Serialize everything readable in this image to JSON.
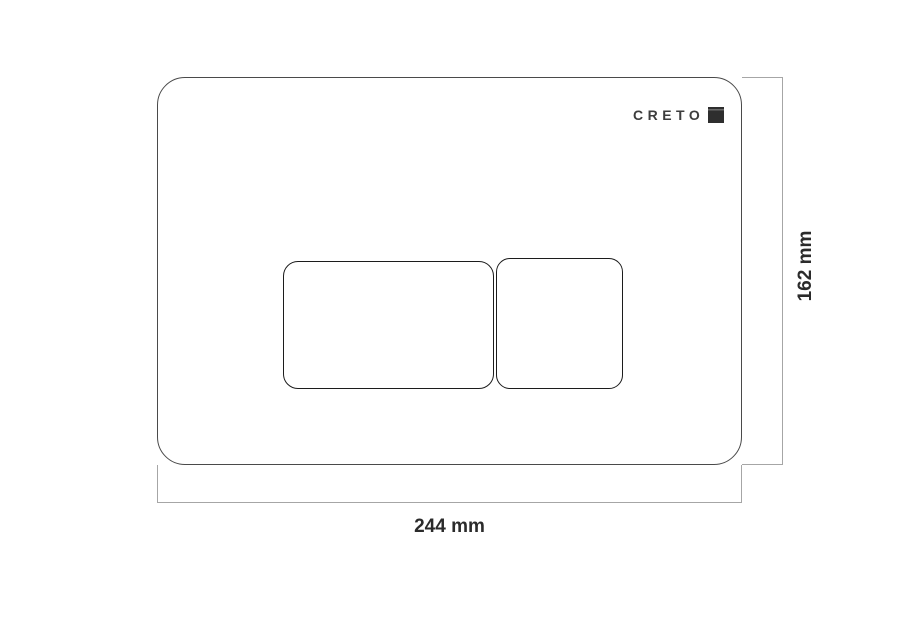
{
  "diagram": {
    "brand": {
      "logo_text": "CRETO"
    },
    "dimension_labels": {
      "width": "244 mm",
      "height": "162 mm"
    }
  },
  "colors": {
    "background": "#ffffff",
    "plate_outline": "#4a4a4a",
    "button_outline": "#1c1c1c",
    "dimension_line": "#a6a6a6",
    "label_text": "#2b2b2b",
    "logo_text": "#3d3d3d",
    "logo_mark": "#2e2e2e"
  }
}
